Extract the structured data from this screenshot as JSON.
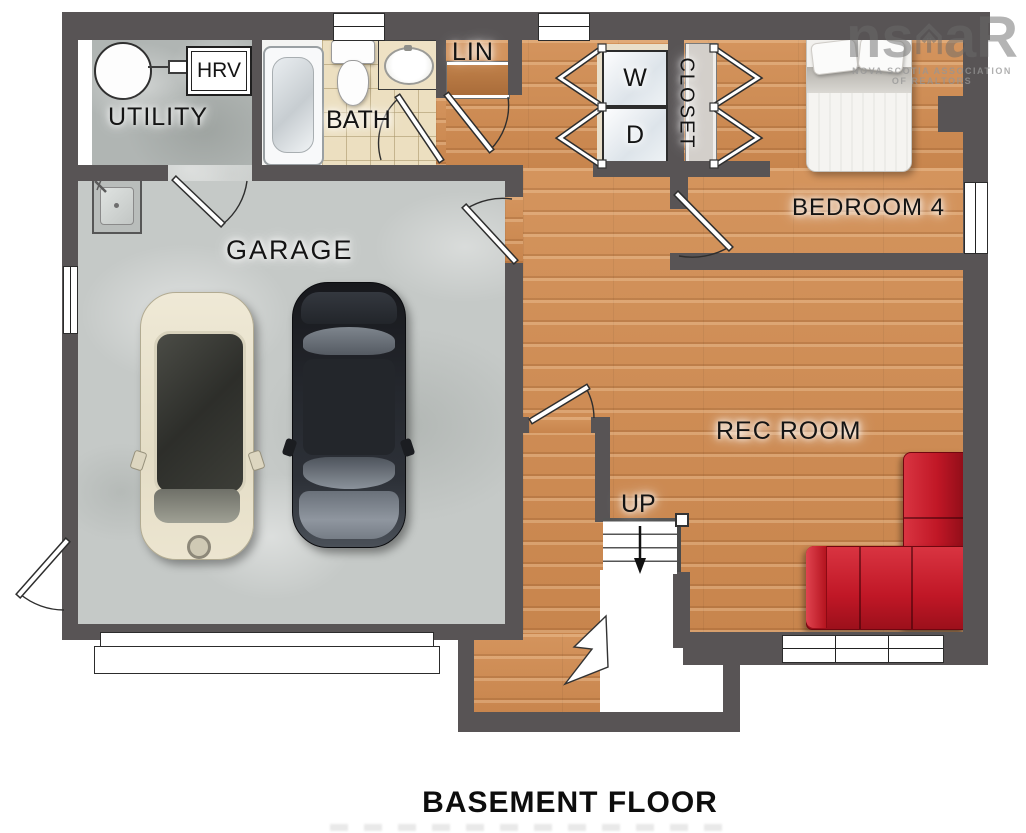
{
  "title": "BASEMENT FLOOR",
  "rooms": {
    "utility": {
      "label": "UTILITY"
    },
    "bath": {
      "label": "BATH"
    },
    "lin": {
      "label": "LIN"
    },
    "closet": {
      "label": "CLOSET"
    },
    "bedroom4": {
      "label": "BEDROOM 4"
    },
    "garage": {
      "label": "GARAGE"
    },
    "rec_room": {
      "label": "REC ROOM"
    }
  },
  "appliances": {
    "washer": "W",
    "dryer": "D",
    "hrv": "HRV"
  },
  "stairs": {
    "direction_label": "UP"
  },
  "watermark": {
    "prefix": "ns",
    "suffix": "aR",
    "line1": "NOVA SCOTIA ASSOCIATION",
    "line2": "OF REALTORS"
  },
  "colors": {
    "wall": "#585455",
    "wood_floor": "#cd8d55",
    "concrete_floor": "#c5c9c7",
    "bath_tile": "#ecdfc0",
    "sofa_red": "#c82131",
    "car_cream": "#e9e2cd",
    "car_dark": "#2b2e34"
  }
}
